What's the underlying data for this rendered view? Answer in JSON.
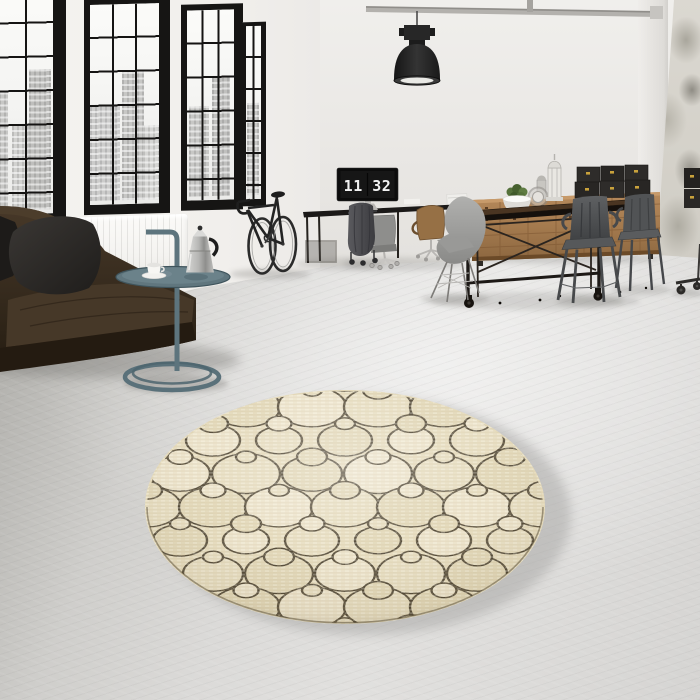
{
  "scene": {
    "label": "loft interior with round circle-pattern rug",
    "window_count": 4
  },
  "clock": {
    "display": "11 32",
    "hours": "11",
    "minutes": "32"
  },
  "rug": {
    "center_x": 345,
    "center_y": 507,
    "radius": 198,
    "squash": 0.585,
    "base_color": "#e7ddc0",
    "line_color": "#2a2113",
    "line_width": 2.4,
    "fills": [
      "#e9e0c5",
      "#e2d8b9",
      "#efe7d1"
    ],
    "big_radii": [
      34,
      34,
      27,
      34,
      30,
      23
    ],
    "small_radius_min": 10,
    "spacing_x": 66,
    "spacing_y": 57
  },
  "palette": {
    "wall": "#eae8e5",
    "wall_distressed": "#d6d3cb",
    "window_frame": "#161514",
    "floor_light": "#e1e0de",
    "floor_dark": "#91918a",
    "sofa_leather": "#3a2e21",
    "pillow": "#2b2926",
    "side_table": "#5d747d",
    "moka_pot": "#c6c6c4",
    "bike": "#262626",
    "desk": "#1b1918",
    "monitor_screen": "#0d0d0d",
    "clock_digits": "#f2f2f2",
    "sideboard_wood": "#a87d52",
    "box_dark": "#2c2a28",
    "box_clasp": "#c9a23c",
    "plant_green": "#4e6b33",
    "table_wood": "#432f1e",
    "tolix_chair": "#4c4e50",
    "eames_chair": "#9c9c9a",
    "lamp_shade": "#242424"
  },
  "objects": [
    "pendant-lamp",
    "ceiling-pipe",
    "industrial-windows",
    "radiator",
    "leather-sofa",
    "pillows",
    "side-table",
    "moka-pot",
    "coffee-cup",
    "bicycle",
    "desk",
    "flip-clock-monitor",
    "coat-rack",
    "office-chairs",
    "eames-chair",
    "sideboard",
    "storage-boxes",
    "plant",
    "lanterns",
    "dining-table",
    "tolix-chairs",
    "round-rug"
  ]
}
